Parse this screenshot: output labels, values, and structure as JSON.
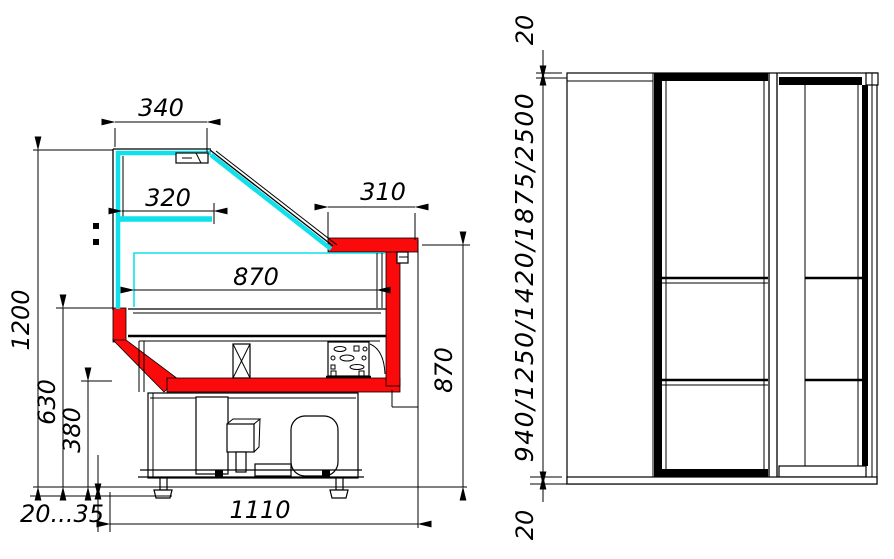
{
  "drawing": {
    "kind": "technical-drawing",
    "views": {
      "left": "side-section-of-serve-over-display-case",
      "right": "front-view-of-tall-cabinet"
    },
    "dims": {
      "left": {
        "top_glass": "340",
        "shelf": "320",
        "rear_top": "310",
        "deck": "870",
        "height": "1200",
        "front_lower": "630",
        "bumper": "380",
        "legs": "20...35",
        "depth": "1110",
        "rear_height": "870"
      },
      "right": {
        "top": "20",
        "heights": "940/1250/1420/1875/2500",
        "bottom": "20"
      }
    },
    "colors": {
      "glass": "#0fe0ea",
      "highlight": "#fa0a0a",
      "line": "#000000",
      "background": "#ffffff"
    }
  }
}
